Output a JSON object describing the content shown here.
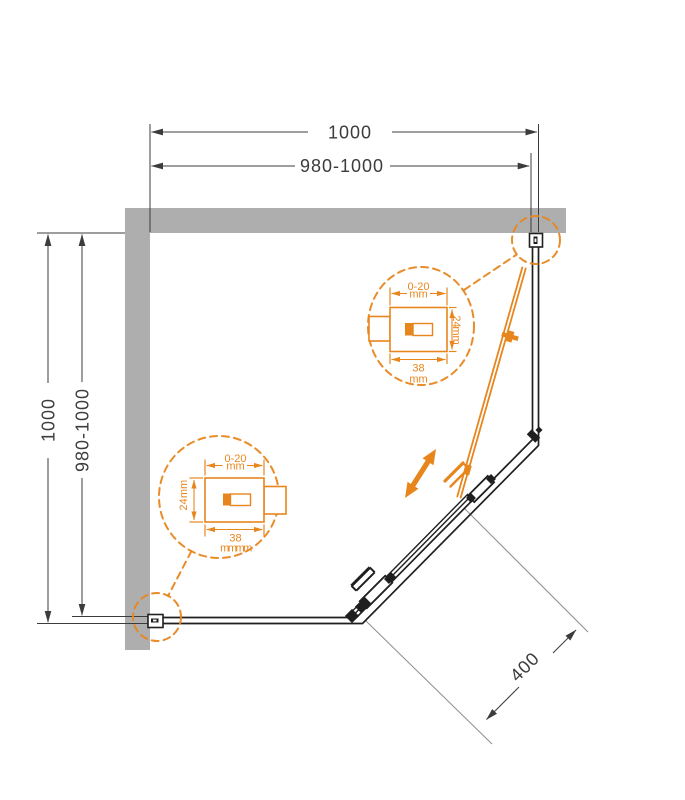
{
  "colors": {
    "accent_orange": "#E8861E",
    "wall_gray": "#AEAEAE",
    "dimension_line": "#3C3C3C",
    "frame_black": "#1F1F1F",
    "extension_gray": "#8F8F8F"
  },
  "dimensions": {
    "top_overall": "1000",
    "top_adjustable": "980-1000",
    "left_overall": "1000",
    "left_adjustable": "980-1000",
    "door_opening": "400"
  },
  "detail_top": {
    "adjustment_range": "0-20",
    "adjustment_unit": "mm",
    "profile_depth": "24",
    "profile_depth_unit": "mm",
    "profile_width": "38",
    "profile_width_unit": "mm"
  },
  "detail_bottom": {
    "adjustment_range": "0-20",
    "adjustment_unit": "mm",
    "profile_depth": "24",
    "profile_depth_unit": "mm",
    "profile_width": "38",
    "profile_width_unit": "mmmm"
  }
}
